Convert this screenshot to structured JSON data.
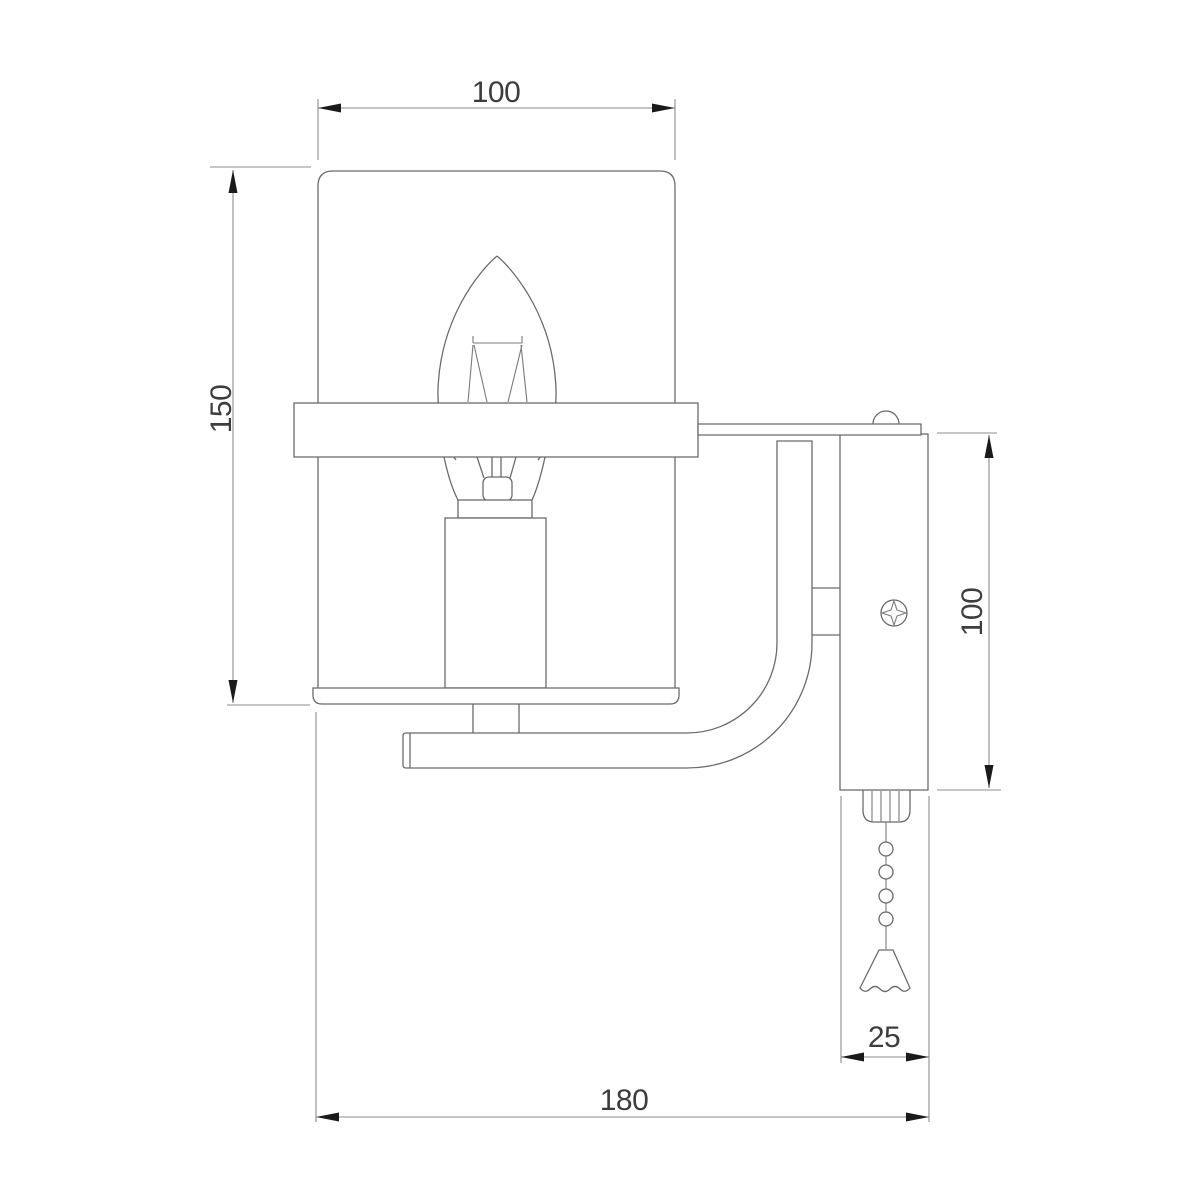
{
  "page": {
    "background": "#ffffff"
  },
  "drawing": {
    "type": "technical-dimension-drawing",
    "subject": "wall sconce side elevation: cylindrical shade, candle bulb, curved mounting arm, wall plate with screw and pull chain",
    "colors": {
      "object_line": "#6b6b6b",
      "dimension_line": "#8c8c8c",
      "arrowhead": "#1a1a1a",
      "label_text": "#3d3d3d",
      "background": "#ffffff"
    },
    "dimensions": {
      "shade_width": "100",
      "overall_height": "150",
      "wall_plate_height": "100",
      "wall_plate_depth": "25",
      "overall_depth": "180"
    }
  }
}
